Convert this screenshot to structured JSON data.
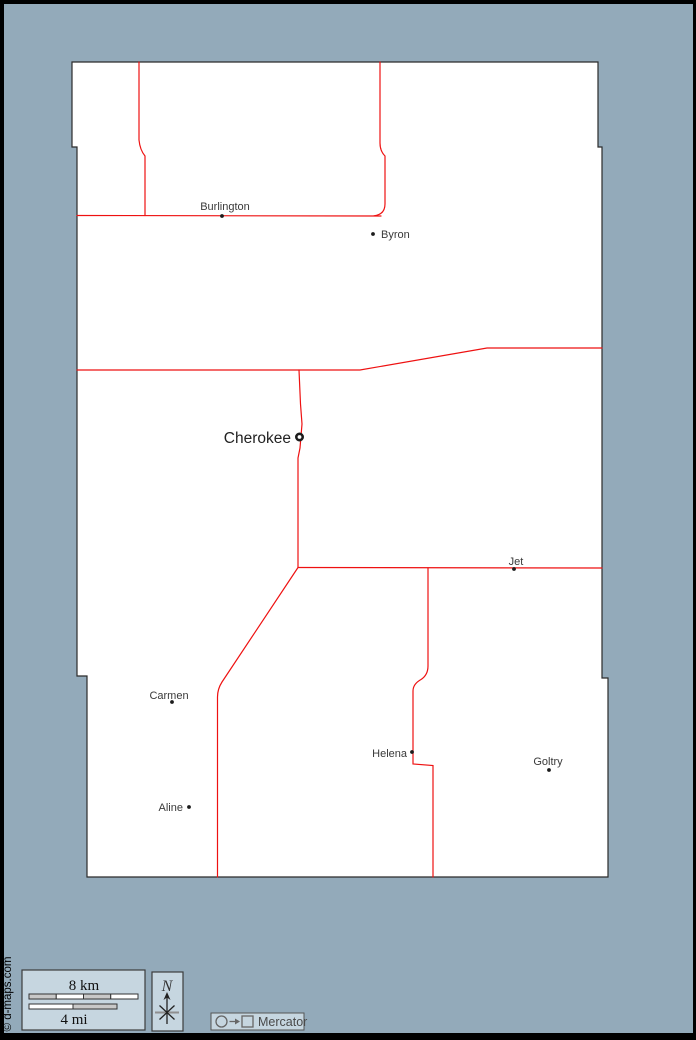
{
  "map": {
    "colors": {
      "background": "#93aaba",
      "frame": "#000000",
      "county_fill": "#ffffff",
      "county_border": "#2b2b2b",
      "road": "#ee1111",
      "town_dot": "#1c1c1c",
      "label": "#3a3a3a",
      "seat_label": "#222222",
      "box_fill": "#c6d6e0",
      "box_border": "#3c3c3c",
      "bar_gray": "#c8c8c8",
      "bar_white": "#ffffff"
    },
    "outline_points": "72,62 598,62 598,147 602,147 602,678 608,678 608,877 87,877 87,676 77,676 77,147 72,147",
    "roads": [
      "M139,62 L139,140 Q140,150 145,156 L145,215.5",
      "M77,215.5 L381,216",
      "M380,62 L380,143 Q380,151 385,156 L385,204 Q385,214.5 374,215.8",
      "M77,370 L299,370 L360,370 L487,348 L602,348",
      "M299,370 L300.5,404 L302,424 L300,448 L298,458 L298,567",
      "M298,567.5 L602,568",
      "M298,567.5 L222,682 Q217.5,689 217.5,697 L217.5,877",
      "M428,568 L428,666 Q428,675 421,679.5 Q413,684 413,691 L413,764 L433,765.5 L433,877"
    ],
    "towns": [
      {
        "name": "Burlington",
        "x": 222,
        "y": 216,
        "label_x": 225,
        "label_y": 210,
        "anchor": "middle",
        "marker": "dot"
      },
      {
        "name": "Byron",
        "x": 373,
        "y": 234,
        "label_x": 381,
        "label_y": 238,
        "anchor": "start",
        "marker": "dot"
      },
      {
        "name": "Cherokee",
        "x": 299.5,
        "y": 437,
        "label_x": 291,
        "label_y": 443,
        "anchor": "end",
        "marker": "ring"
      },
      {
        "name": "Jet",
        "x": 514,
        "y": 569,
        "label_x": 516,
        "label_y": 565,
        "anchor": "middle",
        "marker": "dot"
      },
      {
        "name": "Carmen",
        "x": 172,
        "y": 702,
        "label_x": 169,
        "label_y": 699,
        "anchor": "middle",
        "marker": "dot"
      },
      {
        "name": "Helena",
        "x": 412,
        "y": 752,
        "label_x": 407,
        "label_y": 757,
        "anchor": "end",
        "marker": "dot"
      },
      {
        "name": "Goltry",
        "x": 549,
        "y": 770,
        "label_x": 548,
        "label_y": 765,
        "anchor": "middle",
        "marker": "dot"
      },
      {
        "name": "Aline",
        "x": 189,
        "y": 807,
        "label_x": 183,
        "label_y": 811,
        "anchor": "end",
        "marker": "dot"
      }
    ]
  },
  "legend": {
    "scale": {
      "km_label": "8 km",
      "mi_label": "4 mi",
      "km_segments": [
        "gray",
        "white",
        "gray",
        "white"
      ],
      "mi_segments": [
        "white",
        "gray"
      ]
    },
    "compass": {
      "north_label": "N"
    },
    "projection": {
      "label": "Mercator"
    },
    "copyright": "© d-maps.com"
  }
}
